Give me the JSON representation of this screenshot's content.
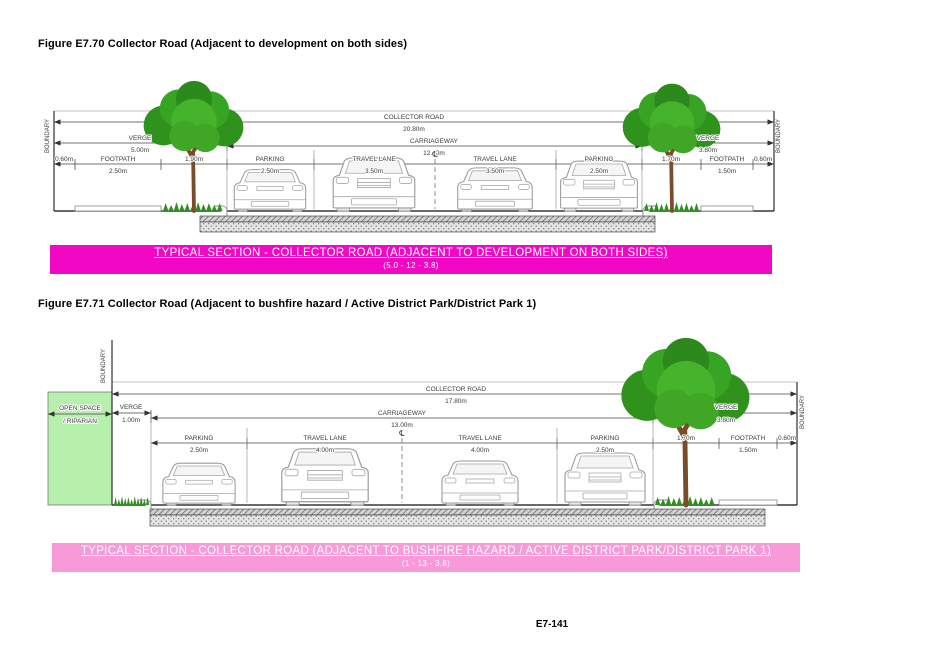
{
  "page": {
    "number": "E7-141"
  },
  "colors": {
    "banner1": "#f208c4",
    "banner2": "#f79ad7",
    "open_space": "#b7efad",
    "tree_green": "#37a424",
    "trunk_brown": "#7a4c28"
  },
  "fig1": {
    "caption": "Figure E7.70 Collector Road (Adjacent to development on both sides)",
    "banner": {
      "title": "TYPICAL SECTION - COLLECTOR ROAD (ADJACENT TO DEVELOPMENT ON BOTH SIDES)",
      "subtitle": "(5.0 - 12 - 3.8)"
    },
    "labels": {
      "boundary_left": "BOUNDARY",
      "boundary_right": "BOUNDARY",
      "collector_road": "COLLECTOR ROAD",
      "collector_road_dim": "20.80m",
      "carriageway": "CARRIAGEWAY",
      "carriageway_dim": "12.00m",
      "verge_left": "VERGE",
      "verge_left_dim": "5.00m",
      "verge_right": "VERGE",
      "verge_right_dim": "3.80m",
      "offset_left_dim": "0.60m",
      "footpath_left": "FOOTPATH",
      "footpath_left_dim": "2.50m",
      "tree_strip_left_dim": "1.90m",
      "parking_left": "PARKING",
      "parking_left_dim": "2.50m",
      "travel_left": "TRAVEL LANE",
      "travel_left_dim": "3.50m",
      "centerline": "℄",
      "travel_right": "TRAVEL LANE",
      "travel_right_dim": "3.50m",
      "parking_right": "PARKING",
      "parking_right_dim": "2.50m",
      "tree_strip_right_dim": "1.70m",
      "footpath_right": "FOOTPATH",
      "footpath_right_dim": "1.50m",
      "offset_right_dim": "0.60m"
    }
  },
  "fig2": {
    "caption": "Figure E7.71 Collector Road (Adjacent to bushfire hazard / Active District Park/District Park 1)",
    "banner": {
      "title": "TYPICAL SECTION - COLLECTOR ROAD (ADJACENT TO BUSHFIRE HAZARD / ACTIVE DISTRICT PARK/DISTRICT PARK 1)",
      "subtitle": "(1 - 13 - 3.8)"
    },
    "labels": {
      "open_space_1": "OPEN SPACE",
      "open_space_2": "/ RIPARIAN",
      "boundary_left": "BOUNDARY",
      "boundary_right": "BOUNDARY",
      "collector_road": "COLLECTOR ROAD",
      "collector_road_dim": "17.80m",
      "carriageway": "CARRIAGEWAY",
      "carriageway_dim": "13.00m",
      "verge_left": "VERGE",
      "verge_left_dim": "1.00m",
      "verge_right": "VERGE",
      "verge_right_dim": "3.80m",
      "parking_left": "PARKING",
      "parking_left_dim": "2.50m",
      "travel_left": "TRAVEL LANE",
      "travel_left_dim": "4.00m",
      "centerline": "℄",
      "travel_right": "TRAVEL LANE",
      "travel_right_dim": "4.00m",
      "parking_right": "PARKING",
      "parking_right_dim": "2.50m",
      "tree_strip_right_dim": "1.70m",
      "footpath_right": "FOOTPATH",
      "footpath_right_dim": "1.50m",
      "offset_right_dim": "0.60m"
    }
  }
}
